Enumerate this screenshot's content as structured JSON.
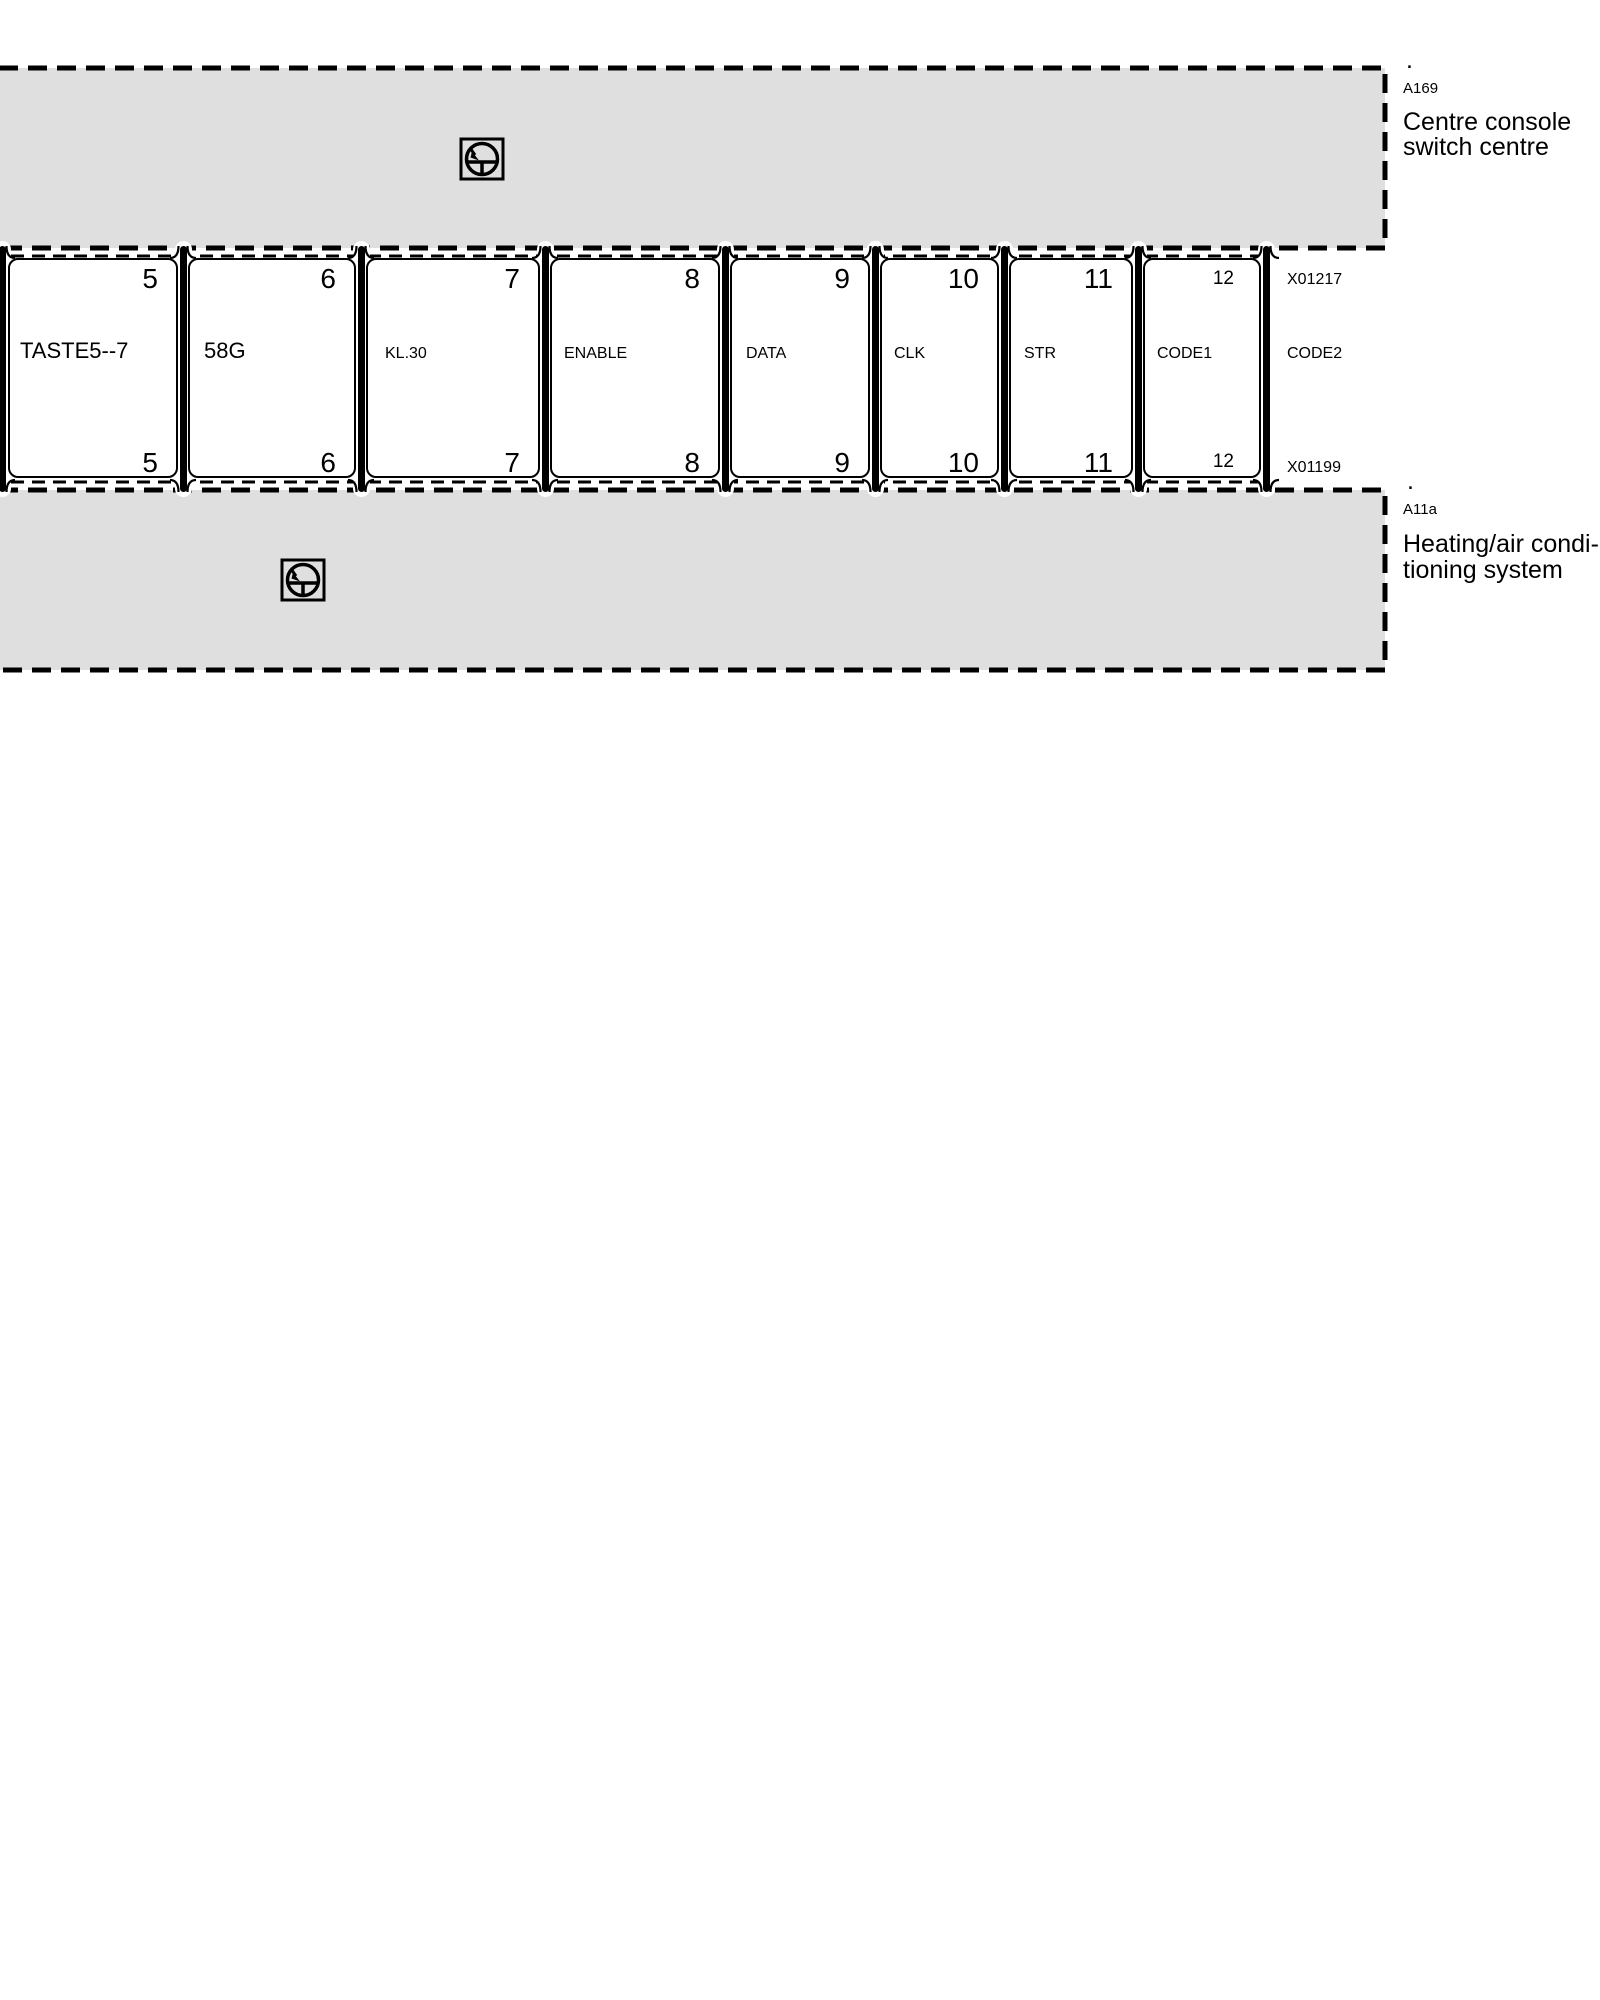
{
  "top_component": {
    "dot": ".",
    "code": "A169",
    "name_line1": "Centre console",
    "name_line2": "switch centre",
    "icon": "control-unit-icon"
  },
  "bottom_component": {
    "dot": ".",
    "code": "A11a",
    "name_line1": "Heating/air condi-",
    "name_line2": "tioning system",
    "icon": "control-unit-icon"
  },
  "connectors": {
    "top": "X01217",
    "bottom": "X01199"
  },
  "pins": [
    {
      "top": "5",
      "bottom": "5",
      "label": "TASTE5--7"
    },
    {
      "top": "6",
      "bottom": "6",
      "label": "58G"
    },
    {
      "top": "7",
      "bottom": "7",
      "label": "KL.30"
    },
    {
      "top": "8",
      "bottom": "8",
      "label": "ENABLE"
    },
    {
      "top": "9",
      "bottom": "9",
      "label": "DATA"
    },
    {
      "top": "10",
      "bottom": "10",
      "label": "CLK"
    },
    {
      "top": "11",
      "bottom": "11",
      "label": "STR"
    },
    {
      "top": "12",
      "bottom": "12",
      "label": "CODE1"
    },
    {
      "label": "CODE2"
    }
  ],
  "colors": {
    "component_fill": "#dfdfdf",
    "line": "#000000",
    "background": "#ffffff"
  }
}
